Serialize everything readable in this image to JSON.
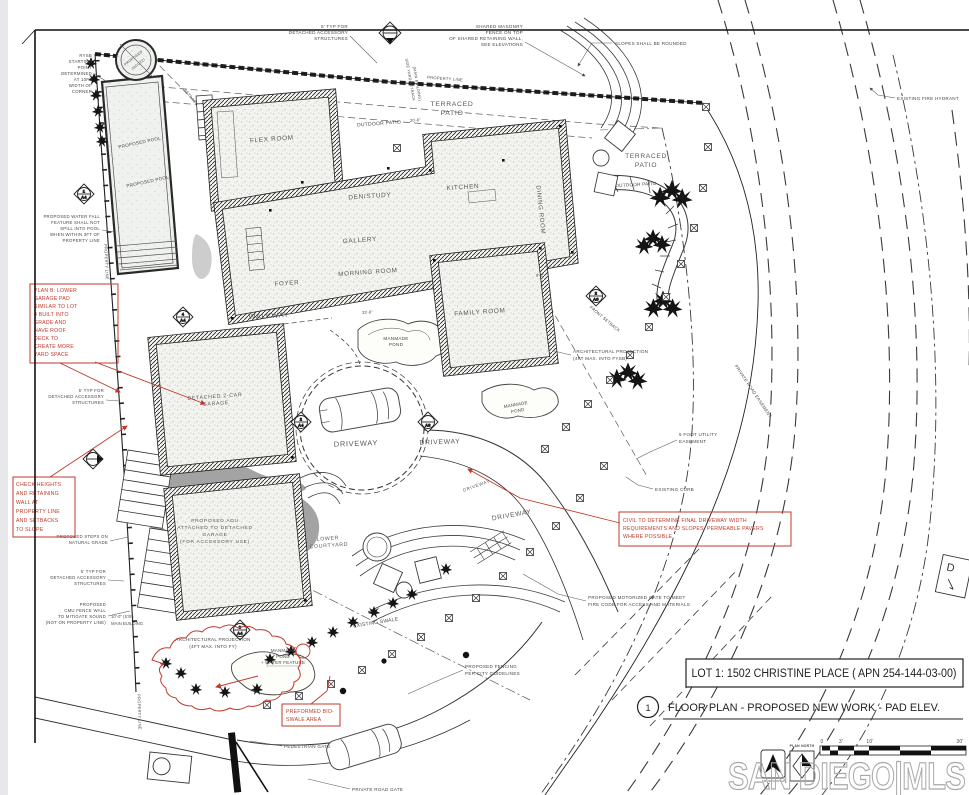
{
  "colors": {
    "red": "#c0392b",
    "ink": "#222222",
    "label": "#474747",
    "watermark": "#a8a8a8"
  },
  "title_block": {
    "lot_line": "LOT 1:  1502 CHRISTINE PLACE ( APN 254-144-03-00)",
    "detail_number": "1",
    "drawing_title": "FLOOR PLAN - PROPOSED NEW WORK - PAD ELEV."
  },
  "watermark": {
    "text": "SAN DIEGO|MLS"
  },
  "scale_bar": {
    "ticks": [
      "0",
      "3'",
      "10'",
      "30'"
    ],
    "plan_north": "PLAN NORTH",
    "true_north": "TRUE NORTH"
  },
  "rooms": {
    "flex": "FLEX ROOM",
    "den": "DEN/STUDY",
    "kitchen": "KITCHEN",
    "gallery": "GALLERY",
    "dining": "DINING ROOM",
    "morning": "MORNING ROOM",
    "foyer": "FOYER",
    "family": "FAMILY ROOM",
    "walkway": "WALKWAY",
    "garage1": "DETACHED 2-CAR",
    "garage2": "GARAGE",
    "adu": [
      "PROPOSED ADU",
      "ATTACHED TO DETACHED",
      "GARAGE",
      "(FOR ACCESSORY USE)"
    ],
    "courtyard1": "LOWER",
    "courtyard2": "COURTYARD",
    "driveway": "DRIVEWAY"
  },
  "site": {
    "terraced1": "TERRACED",
    "terraced2": "PATIO",
    "outdoor_patio": "OUTDOOR PATIO",
    "pool": "PROPOSED POOL",
    "jacuzzi1": "PROPOSED",
    "jacuzzi2": "JACUZZI",
    "pond1": "MANMADE",
    "pond2": "POND",
    "pond_wf3": "+ WATER FEATURE",
    "property_line": "PROPERTY LINE",
    "side_yard1": "SIDE YARD SETBACK",
    "side_yard2": "(MAIN BUILDING)",
    "front_setback": "FRONT SETBACK",
    "setback": "SETBACK",
    "private_road_easement": "PRIVATE ROAD EASEMENT",
    "swale": "EXISTING SWALE",
    "d_sign": "D"
  },
  "callouts": {
    "typ": [
      "5' TYP FOR",
      "DETACHED ACCESSORY",
      "STRUCTURES"
    ],
    "masonry": [
      "SHARED MASONRY",
      "FENCE ON TOP",
      "OF SHARED RETAINING WALL,",
      "SEE ELEVATIONS"
    ],
    "slopes": "SLOPES SHALL BE ROUNDED",
    "hydrant": "EXISTING FIRE HYDRANT",
    "rysb": [
      "RYSB",
      "STARTING",
      "POINT",
      "DETERMINED",
      "AT 10FT",
      "WIDTH OF",
      "CORNER"
    ],
    "waterfall": [
      "PROPOSED WATER FALL",
      "FEATURE SHALL NOT",
      "SPILL INTO POOL",
      "WHEN WITHIN 3FT OF",
      "PROPERTY LINE"
    ],
    "steps": [
      "PROPOSED STEPS ON",
      "NATURAL GRADE"
    ],
    "cmu": [
      "PROPOSED",
      "CMU FENCE WALL",
      "TO MITIGATE SOUND",
      "(NOT ON PROPERTY LINE)"
    ],
    "arch_fy": [
      "ARCHITECTURAL PROJECTION",
      "(4FT MAX. INTO FY)"
    ],
    "arch_fysb": [
      "ARCHITECTURAL PROJECTION",
      "(4FT MAX. INTO FYSB)"
    ],
    "fencing": [
      "PROPOSED FENCING",
      "PER CITY GUIDELINES"
    ],
    "motor_gate": [
      "PROPOSED MOTORIZED GATE TO MEET",
      "FIRE CODE FOR ACCESS AND MATERIALS"
    ],
    "ped_gate": "PEDESTRIAN GATE",
    "road_gate": "PRIVATE ROAD GATE",
    "curb": "EXISTING CURB",
    "utility": [
      "5 FOOT UTILITY",
      "EASEMENT"
    ]
  },
  "red_notes": {
    "plan_b": [
      "PLAN B: LOWER",
      "GARAGE PAD",
      "SIMILAR TO LOT",
      "4 BUILT INTO",
      "GRADE AND",
      "HAVE ROOF",
      "DECK TO",
      "CREATE MORE",
      "YARD SPACE"
    ],
    "check": [
      "CHECK HEIGHTS",
      "AND RETAINING",
      "WALL AT",
      "PROPERTY LINE",
      "AND SETBACKS",
      "TO SLOPE"
    ],
    "civil": [
      "CIVIL TO DETERMINE FINAL DRIVEWAY WIDTH",
      "REQUIREMENTS AND SLOPES.  PERMEABLE PAVERS",
      "WHERE POSSIBLE"
    ],
    "bioswale": [
      "PREFORMED BIO-",
      "SWALE AREA"
    ]
  },
  "dims": {
    "d1": "20'-6\"",
    "d2": "33'-8\"",
    "d3": "9'-8\"",
    "mb1": "10'-0\" (5'/5')",
    "mb2": "MAIN BUILDING"
  },
  "markers": {
    "m1": {
      "num": "1",
      "sheet": "A4"
    },
    "m3": {
      "num": "4",
      "sheet": "A4"
    },
    "m4": {
      "num": "2",
      "sheet": "A4"
    },
    "m5": {
      "num": "",
      "sheet": "A3"
    },
    "m6": {
      "num": "3",
      "sheet": "A4"
    },
    "m7": {
      "num": "2",
      "sheet": "A6"
    }
  }
}
